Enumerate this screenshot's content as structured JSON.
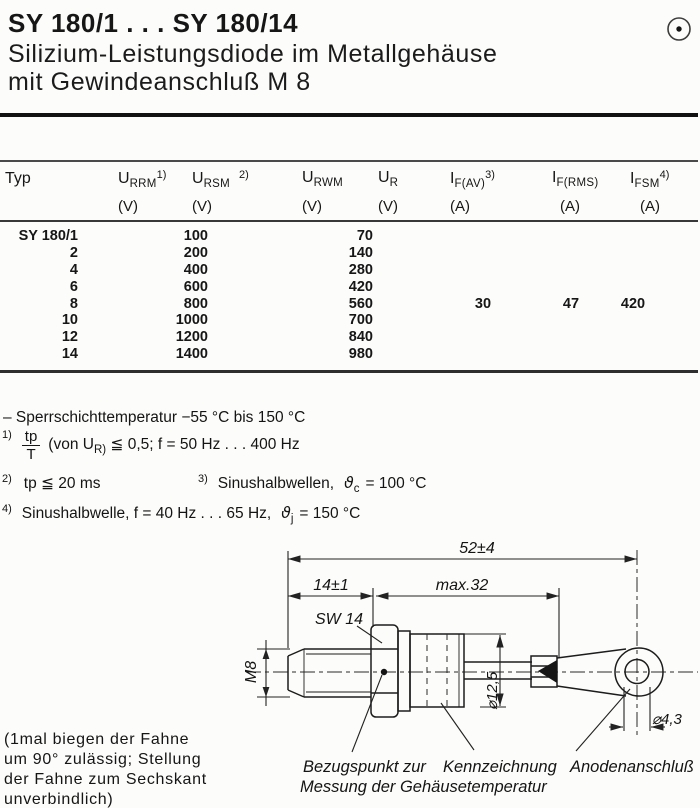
{
  "page": {
    "title": "SY 180/1 . . . SY 180/14",
    "subtitle_line1": "Silizium-Leistungsdiode im Metallgehäuse",
    "subtitle_line2": "mit Gewindeanschluß M 8"
  },
  "table": {
    "headers": [
      {
        "label": "Typ"
      },
      {
        "sym": "U",
        "sub": "RRM",
        "sup": "1)",
        "unit": "(V)"
      },
      {
        "sym": "U",
        "sub": "RSM",
        "sup": "2)",
        "unit": "(V)"
      },
      {
        "sym": "U",
        "sub": "RWM",
        "sup": "",
        "unit": "(V)"
      },
      {
        "sym": "U",
        "sub": "R",
        "sup": "",
        "unit": "(V)"
      },
      {
        "sym": "I",
        "sub": "F(AV)",
        "sup": "3)",
        "unit": "(A)"
      },
      {
        "sym": "I",
        "sub": "F(RMS)",
        "sup": "",
        "unit": "(A)"
      },
      {
        "sym": "I",
        "sub": "FSM",
        "sup": "4)",
        "unit": "(A)"
      }
    ],
    "rows": [
      {
        "typ": "SY 180/1",
        "v1": "100",
        "v2": "70"
      },
      {
        "typ": "2",
        "v1": "200",
        "v2": "140"
      },
      {
        "typ": "4",
        "v1": "400",
        "v2": "280"
      },
      {
        "typ": "6",
        "v1": "600",
        "v2": "420"
      },
      {
        "typ": "8",
        "v1": "800",
        "v2": "560"
      },
      {
        "typ": "10",
        "v1": "1000",
        "v2": "700"
      },
      {
        "typ": "12",
        "v1": "1200",
        "v2": "840"
      },
      {
        "typ": "14",
        "v1": "1400",
        "v2": "980"
      }
    ],
    "if_av": "30",
    "if_rms": "47",
    "ifsm": "420"
  },
  "notes": {
    "temperature": "– Sperrschichttemperatur  −55 °C bis 150 °C",
    "n1": {
      "marker": "1)",
      "num": "tp",
      "den": "T",
      "mid": "(von U",
      "sub": "R)",
      "rest": " ≦ 0,5; f = 50 Hz . . . 400 Hz"
    },
    "n2": {
      "marker": "2)",
      "text": "tp ≦ 20 ms"
    },
    "n3": {
      "marker": "3)",
      "pre": "Sinushalbwellen,",
      "theta": "ϑ",
      "sub": "c",
      "post": "= 100 °C"
    },
    "n4": {
      "marker": "4)",
      "pre": "Sinushalbwelle, f = 40 Hz . . . 65 Hz,",
      "theta": "ϑ",
      "sub": "j",
      "post": "= 150 °C"
    }
  },
  "drawing": {
    "dim_total": "52±4",
    "dim_thread_len": "14±1",
    "dim_body_len": "max.32",
    "label_sw14": "SW 14",
    "label_m8": "M8",
    "dim_body_dia": "⌀12,5",
    "dim_hole_dia": "⌀4,3",
    "caption_ref_point_line1": "Bezugspunkt zur",
    "caption_ref_point_line2": "Messung der Gehäusetemperatur",
    "caption_marking": "Kennzeichnung",
    "caption_anode": "Anodenanschluß"
  },
  "footnote_left": {
    "line1": "(1mal biegen der Fahne",
    "line2": "um 90° zulässig; Stellung",
    "line3": "der Fahne zum Sechskant",
    "line4": "unverbindlich)"
  },
  "colors": {
    "ink": "#161616",
    "paper": "#fcfcfa"
  }
}
